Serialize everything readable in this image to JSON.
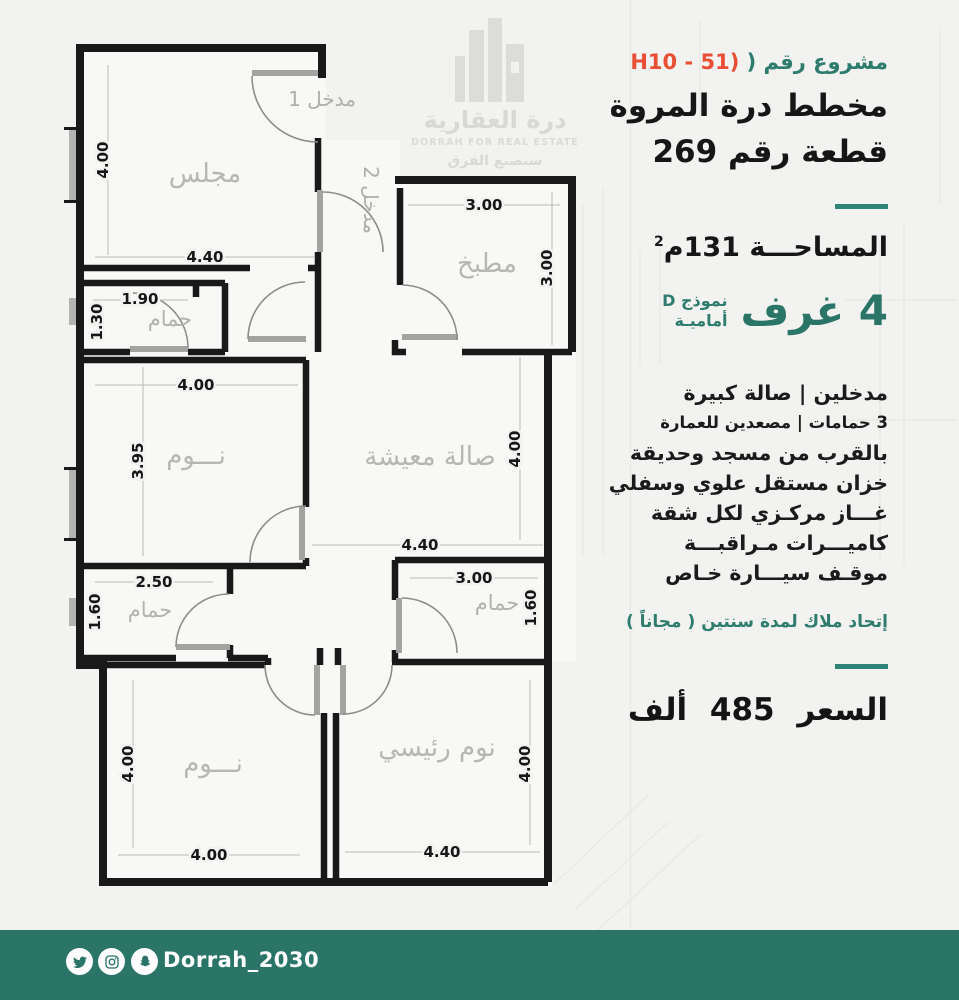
{
  "colors": {
    "teal_text": "#2e7c6e",
    "red_code": "#e84f35",
    "footer_bar": "#2a7568",
    "divider": "#2e8476"
  },
  "header": {
    "project_prefix": "مشروع رقم",
    "project_paren": "(",
    "project_code": "H10 - 51)",
    "title": "مخطط درة المروة",
    "subtitle": "قطعة رقم 269"
  },
  "specs": {
    "area_text": "المساحـــة 131م",
    "area_sup": "2",
    "rooms_count": "4 غرف",
    "model_line1": "نموذج D",
    "model_line2": "أماميـة"
  },
  "features": [
    "مدخلين  |  صالة كبيرة",
    "3 حمامات  |  مصعدين للعمارة",
    "بالقرب من مسجد وحديقة",
    "خزان مستقل علوي وسفلي",
    "غـــاز مركـزي لكل شقة",
    "كاميـــرات مـراقبـــة",
    "موقـف سيـــارة خـاص"
  ],
  "hoa_note": "إتحاد ملاك لمدة سنتين ( مجاناً )",
  "price": {
    "label": "السعر",
    "value": "485",
    "unit": "ألف"
  },
  "floor_plan": {
    "entrance1": "مدخل 1",
    "entrance2": "مدخل 2",
    "rooms": {
      "majlis": {
        "label": "مجلس",
        "w": "4.40",
        "h": "4.00"
      },
      "kitchen": {
        "label": "مطبخ",
        "w": "3.00",
        "h": "3.00"
      },
      "bath_top": {
        "label": "حمام",
        "w": "1.90",
        "h": "1.30"
      },
      "bed_mid": {
        "label": "نـــوم",
        "w": "4.00",
        "h": "3.95"
      },
      "living": {
        "label": "صالة معيشة",
        "w": "4.40",
        "h": "4.00"
      },
      "bath_bl": {
        "label": "حمام",
        "w": "2.50",
        "h": "1.60"
      },
      "bath_br": {
        "label": "حمام",
        "w": "3.00",
        "h": "1.60"
      },
      "bed_bl": {
        "label": "نـــوم",
        "w": "4.00",
        "h": "4.00"
      },
      "bed_master": {
        "label": "نوم رئيسي",
        "w": "4.40",
        "h": "4.00"
      }
    }
  },
  "watermark": {
    "name_ar": "درة العقارية",
    "name_en": "DORRAH FOR REAL ESTATE",
    "tagline": "سنصنع الفرق"
  },
  "logos": {
    "abaad": {
      "line1": "أبــعـاد درة",
      "line2": "مــعـمـاريــون"
    },
    "dorrah": {
      "name_ar": "درة العقارية",
      "name_en": "DORRAH FOR REAL ESTATE",
      "tagline": "سنصنع الفرق"
    }
  },
  "footer": {
    "handle": "Dorrah_2030"
  }
}
